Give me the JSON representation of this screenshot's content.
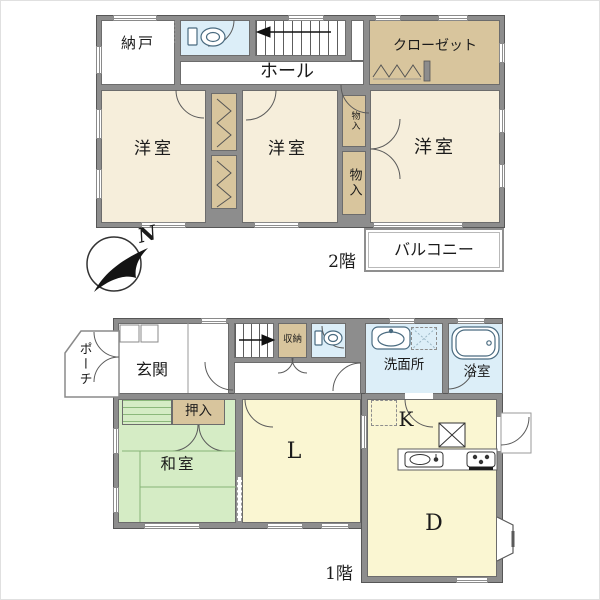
{
  "compass": {
    "north": "N"
  },
  "floor2": {
    "label": "2階",
    "nando": "納戸",
    "hall": "ホール",
    "closet": "クローゼット",
    "yoshitsu_left": "洋室",
    "yoshitsu_mid": "洋室",
    "yoshitsu_right": "洋室",
    "mono_small": "物入",
    "mono_large": "物入",
    "balcony": "バルコニー"
  },
  "floor1": {
    "label": "1階",
    "porch": "ポーチ",
    "genkan": "玄関",
    "shuno": "収納",
    "senmenjo": "洗面所",
    "yokushitsu": "浴室",
    "oshiire": "押入",
    "washitsu": "和室",
    "living": "L",
    "kitchen": "K",
    "dining": "D"
  },
  "colors": {
    "wall": "#8d8d8d",
    "cream": "#f6eedb",
    "tan": "#d8c59d",
    "blue": "#dceef8",
    "green": "#d5ecc5",
    "yellow": "#faf6d2"
  }
}
